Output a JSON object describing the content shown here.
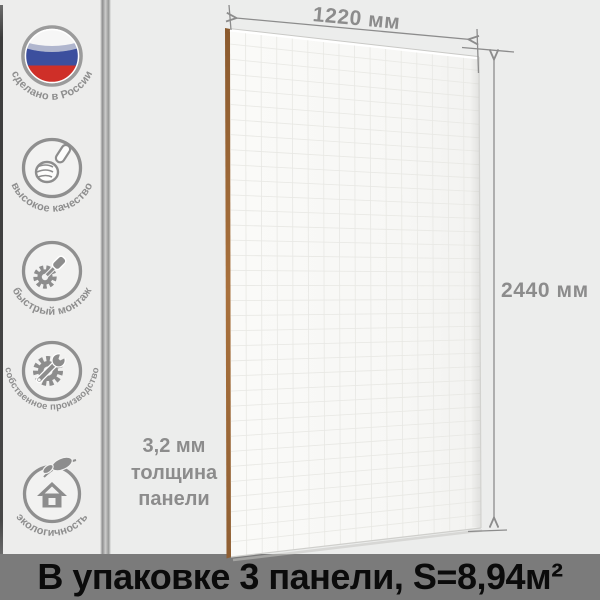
{
  "product": {
    "width_label": "1220 мм",
    "height_label": "2440 мм",
    "thickness_line1": "3,2 мм",
    "thickness_line2": "толщина",
    "thickness_line3": "панели",
    "footer_text": "В упаковке 3 панели, S=8,94м²"
  },
  "badges": [
    {
      "label": "сделано в России",
      "icon": "russia-flag-icon"
    },
    {
      "label": "высокое качество",
      "icon": "thumb-up-icon"
    },
    {
      "label": "быстрый монтаж",
      "icon": "gear-screwdriver-icon"
    },
    {
      "label": "собственное производство",
      "icon": "gear-wrench-icon"
    },
    {
      "label": "экологичность",
      "icon": "eco-house-leaf-icon"
    }
  ],
  "colors": {
    "background": "#ecedec",
    "badge_gray": "#8d8d8d",
    "flag_white": "#f6f6f6",
    "flag_blue": "#3c4f9e",
    "flag_red": "#cf2f28",
    "panel_face": "#f8f8f6",
    "panel_edge_brown": "#9a6a3a",
    "dimension_gray": "#8c8c8c",
    "footer_bg": "#7b7b7b",
    "footer_text": "#0b0b0b"
  }
}
